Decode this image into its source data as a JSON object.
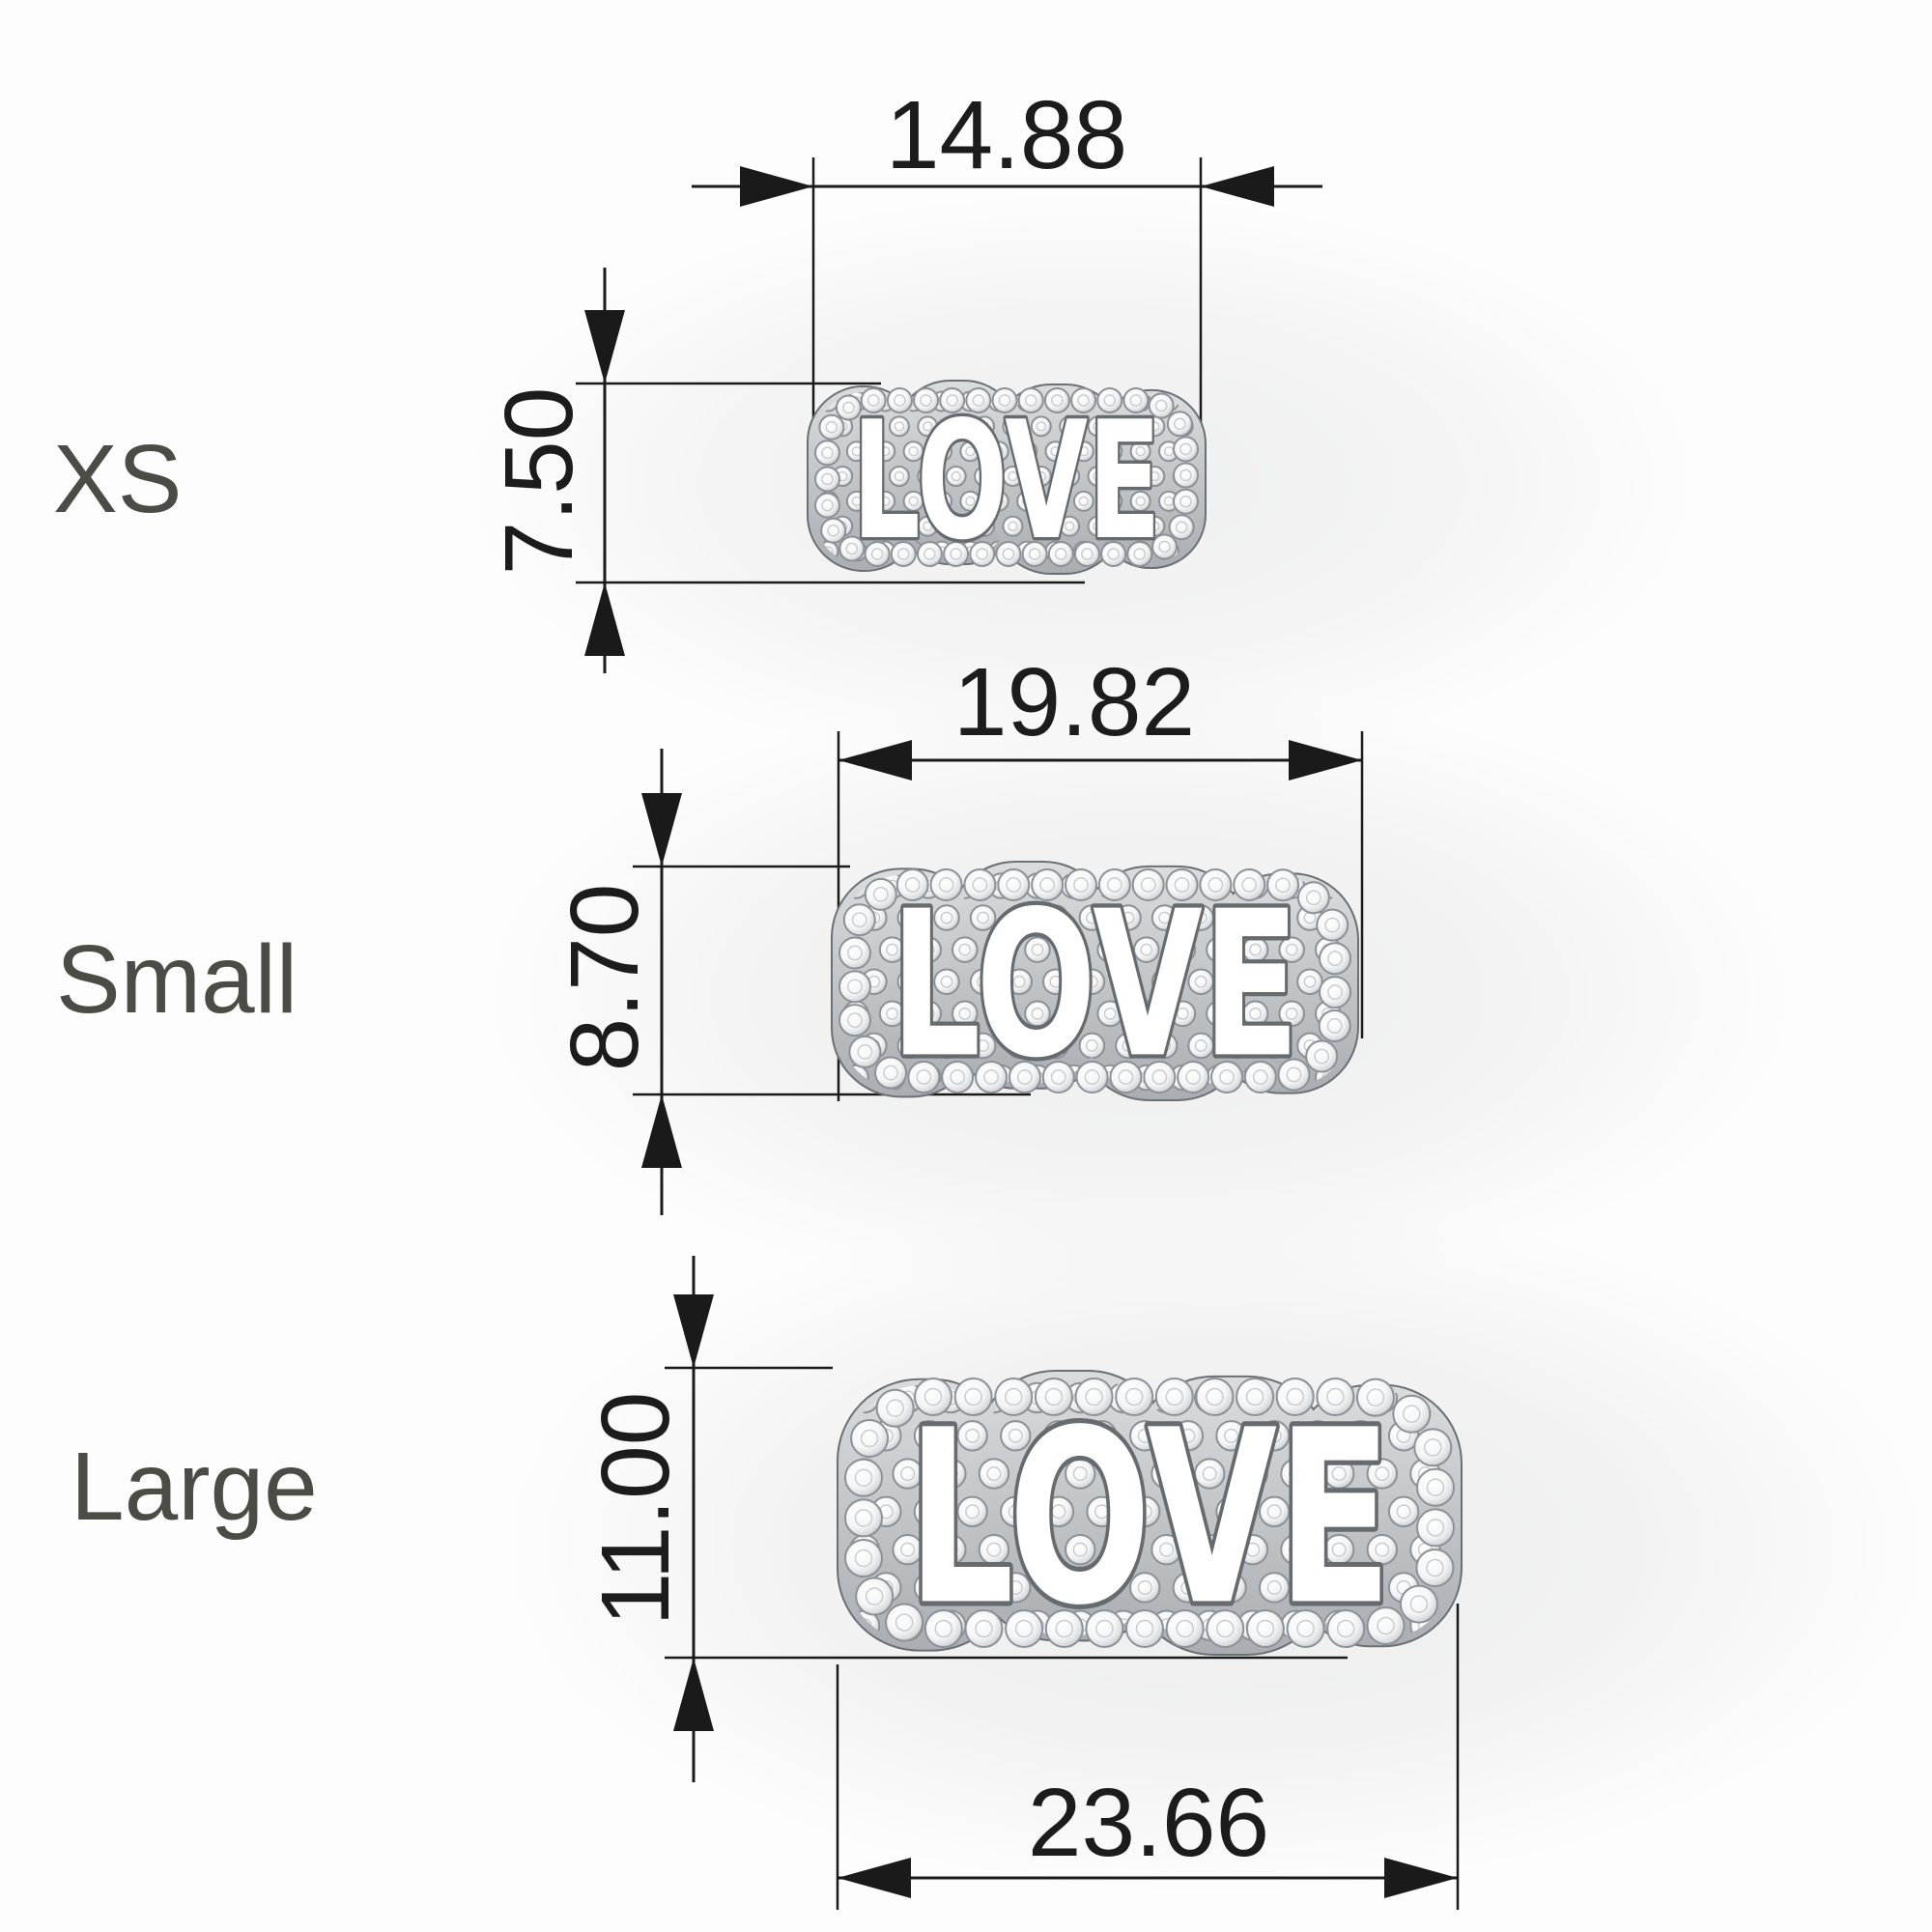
{
  "charm_word": "LOVE",
  "rows": [
    {
      "id": "xs",
      "size_label": "XS",
      "width_mm": "14.88",
      "height_mm": "7.50"
    },
    {
      "id": "small",
      "size_label": "Small",
      "width_mm": "19.82",
      "height_mm": "8.70"
    },
    {
      "id": "large",
      "size_label": "Large",
      "width_mm": "23.66",
      "height_mm": "11.00"
    }
  ],
  "colors": {
    "dimension_lines": "#1a1a1a",
    "dimension_text": "#1c1c1c",
    "size_label_text": "#4c4c46",
    "metal_base": "#b9bdc0",
    "letter_fill": "#ffffff",
    "letter_outline": "#666b70",
    "diamond_edge": "#8d9196"
  }
}
